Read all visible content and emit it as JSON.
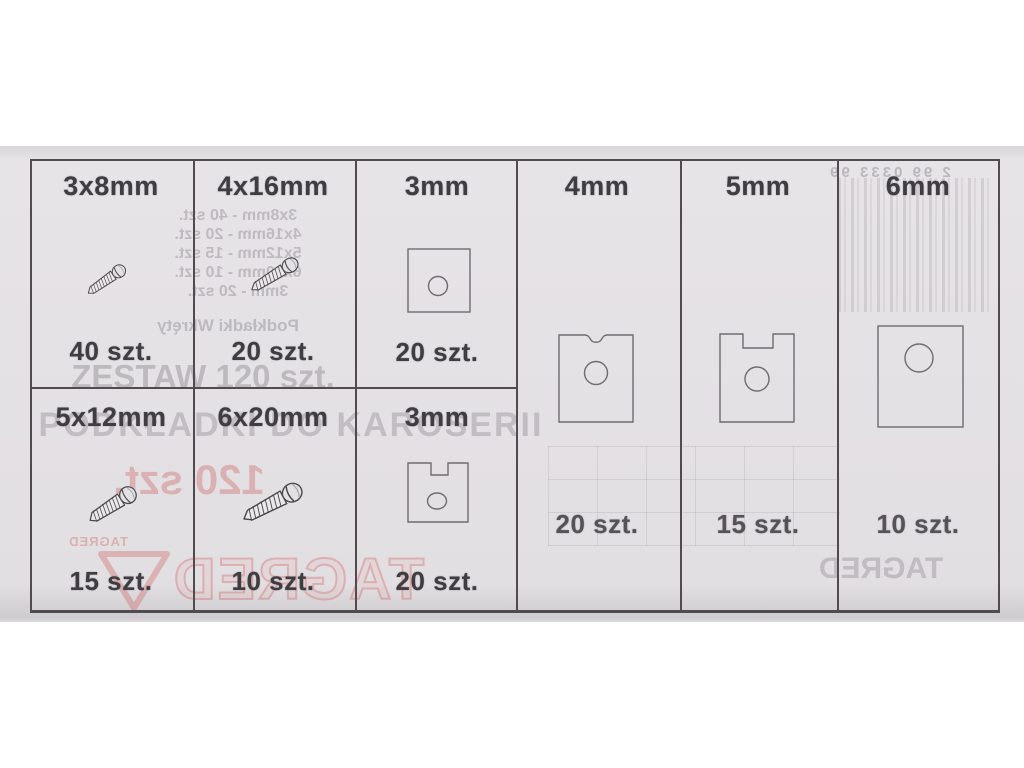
{
  "colors": {
    "paper": "#e4e1e4",
    "line": "#4f4b4f",
    "ink": "#3f3d41",
    "ghost": "#97939a",
    "red": "#c96a6a"
  },
  "cells": {
    "row1": [
      {
        "size": "3x8mm",
        "count": "40 szt."
      },
      {
        "size": "4x16mm",
        "count": "20 szt."
      },
      {
        "size": "3mm",
        "count": "20 szt."
      }
    ],
    "row2": [
      {
        "size": "5x12mm",
        "count": "15 szt."
      },
      {
        "size": "6x20mm",
        "count": "10 szt."
      },
      {
        "size": "3mm",
        "count": "20 szt."
      }
    ],
    "right": [
      {
        "size": "4mm",
        "count": "20 szt."
      },
      {
        "size": "5mm",
        "count": "15 szt."
      },
      {
        "size": "6mm",
        "count": "10 szt."
      }
    ]
  },
  "showthrough": {
    "headline_top": "ZESTAW 120 szt.",
    "headline_main": "PODKŁADKI DO KAROSERII",
    "red_count": "120 szt.",
    "brand_small": "TAGRED",
    "brand_big": "TAGRED",
    "brand_gray": "TAGRED",
    "barcode_digits": "2 99 0333 99",
    "contents_caption": "Podkładki      Wkręty",
    "contents_lines": [
      "3x8mm - 40 szt.",
      "4x16mm - 20 szt.",
      "5x12mm - 15 szt.",
      "6x20mm - 10 szt.",
      "3mm - 20 szt."
    ]
  }
}
